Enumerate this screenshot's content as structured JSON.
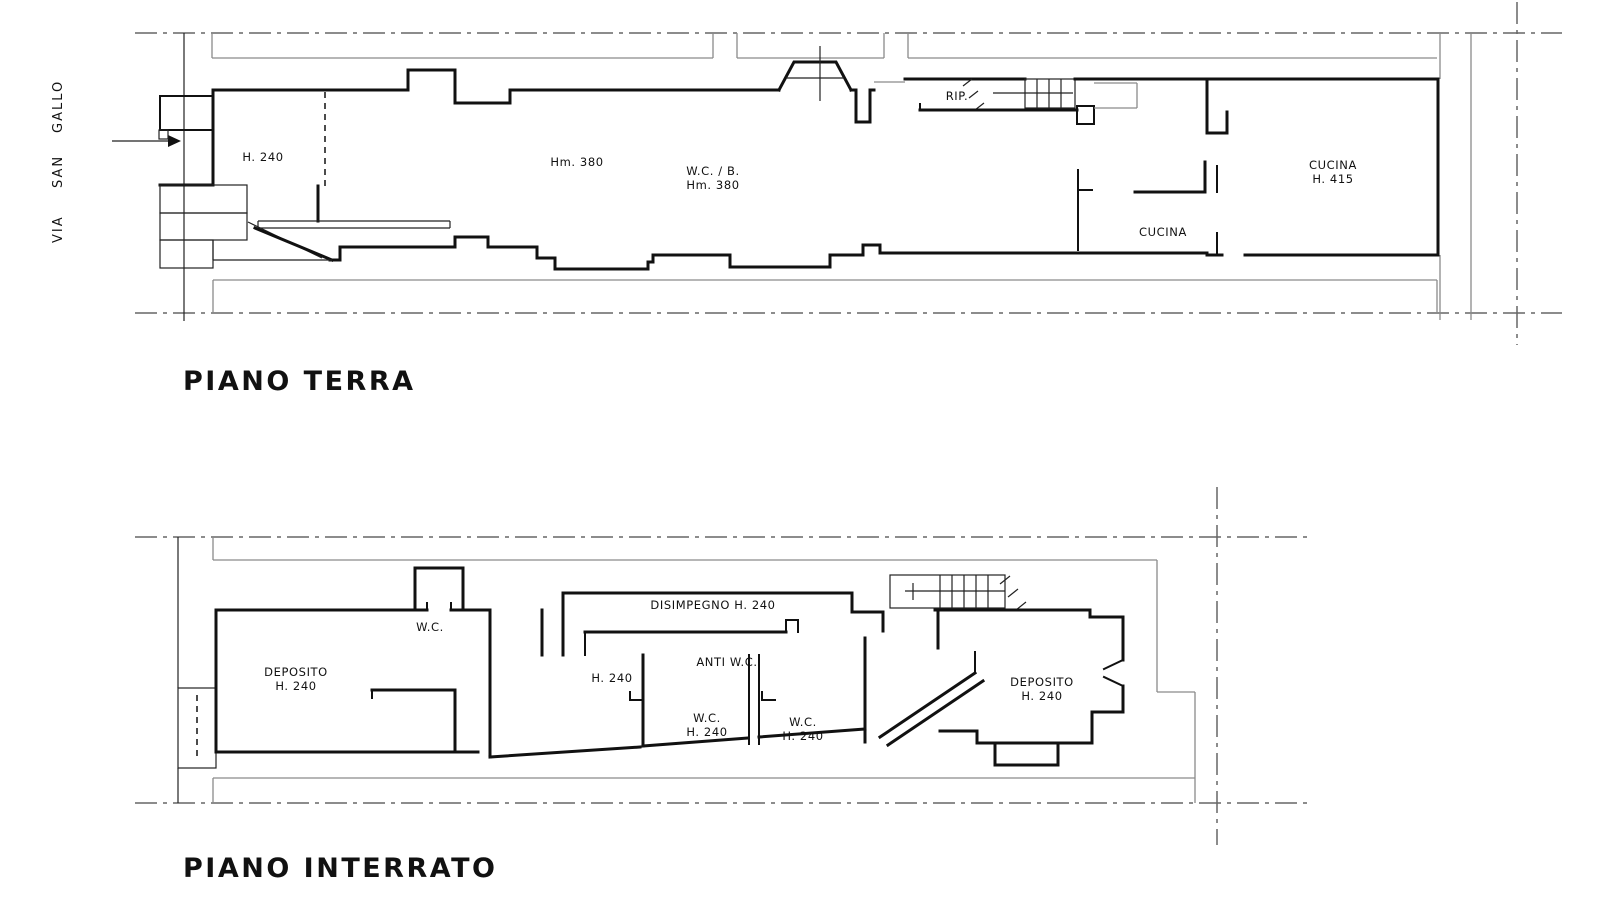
{
  "colors": {
    "ink": "#111111",
    "reference": "#8a8a8a"
  },
  "street_words": [
    "VIA",
    "SAN",
    "GALLO"
  ],
  "plans": {
    "terra": {
      "title": "PIANO TERRA",
      "rooms": [
        "H. 240",
        "Hm. 380",
        "W.C. / B.",
        "Hm. 380",
        "RIP.",
        "CUCINA",
        "CUCINA",
        "H. 415"
      ]
    },
    "interrato": {
      "title": "PIANO INTERRATO",
      "rooms": [
        "DEPOSITO",
        "H. 240",
        "W.C.",
        "DISIMPEGNO  H. 240",
        "ANTI W.C.",
        "H. 240",
        "W.C.",
        "H. 240",
        "W.C.",
        "H. 240",
        "DEPOSITO",
        "H. 240"
      ]
    }
  }
}
